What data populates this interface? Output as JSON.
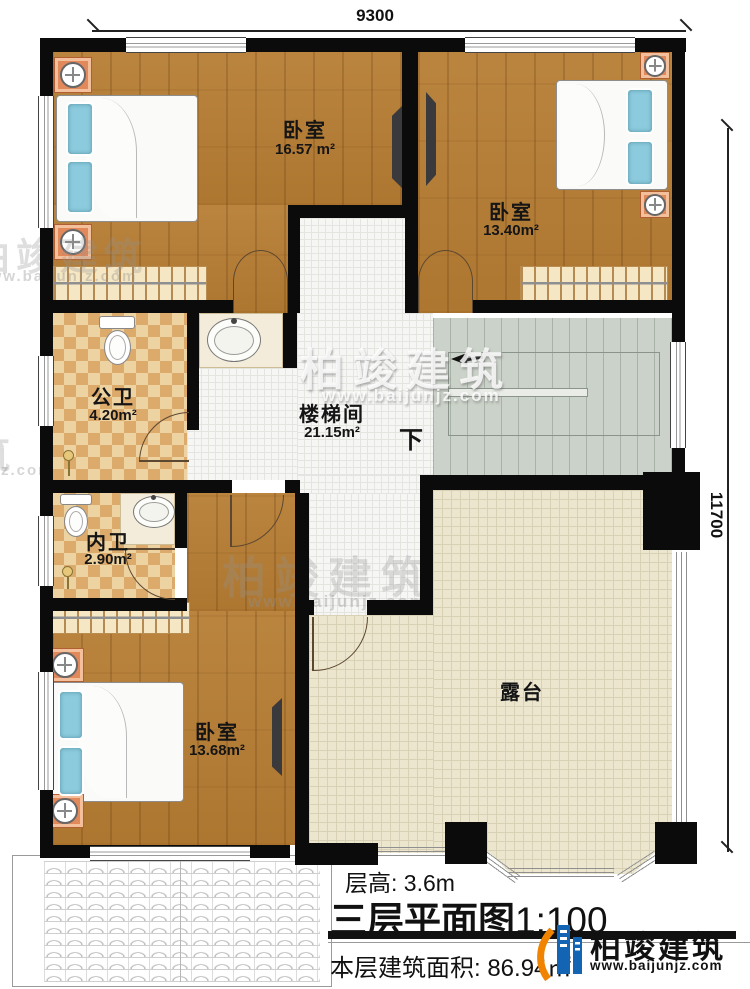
{
  "dimensions": {
    "top": "9300",
    "right": "11700"
  },
  "rooms": {
    "bedroom_tl": {
      "name": "卧室",
      "area": "16.57 m²"
    },
    "bedroom_tr": {
      "name": "卧室",
      "area": "13.40m²"
    },
    "public_bath": {
      "name": "公卫",
      "area": "4.20m²"
    },
    "stairwell": {
      "name": "楼梯间",
      "area": "21.15m²"
    },
    "inner_bath": {
      "name": "内卫",
      "area": "2.90m²"
    },
    "bedroom_bottom": {
      "name": "卧室",
      "area": "13.68m²"
    },
    "terrace": {
      "name": "露台"
    }
  },
  "stairs": {
    "direction_label": "下"
  },
  "footer": {
    "floor_height": "层高: 3.6m",
    "title": "三层平面图",
    "scale": "1:100",
    "area_note": "本层建筑面积: 86.94㎡"
  },
  "branding": {
    "watermark_name": "柏竣建筑",
    "watermark_url": "www.baijunjz.com",
    "logo_name": "柏竣建筑",
    "logo_url": "www.baijunjz.com"
  },
  "colors": {
    "wall": "#0b0b0b",
    "wood_floor": "#b67d33",
    "tile_floor": "#f6f6f4",
    "checker_floor": "#eed3a2",
    "stairs_floor": "#cbd2c9",
    "terrace_floor": "#ece6cf",
    "bed": "#68b4cd",
    "nightstand": "#e2895b",
    "logo_blue": "#1464b4",
    "logo_orange": "#f08300"
  }
}
